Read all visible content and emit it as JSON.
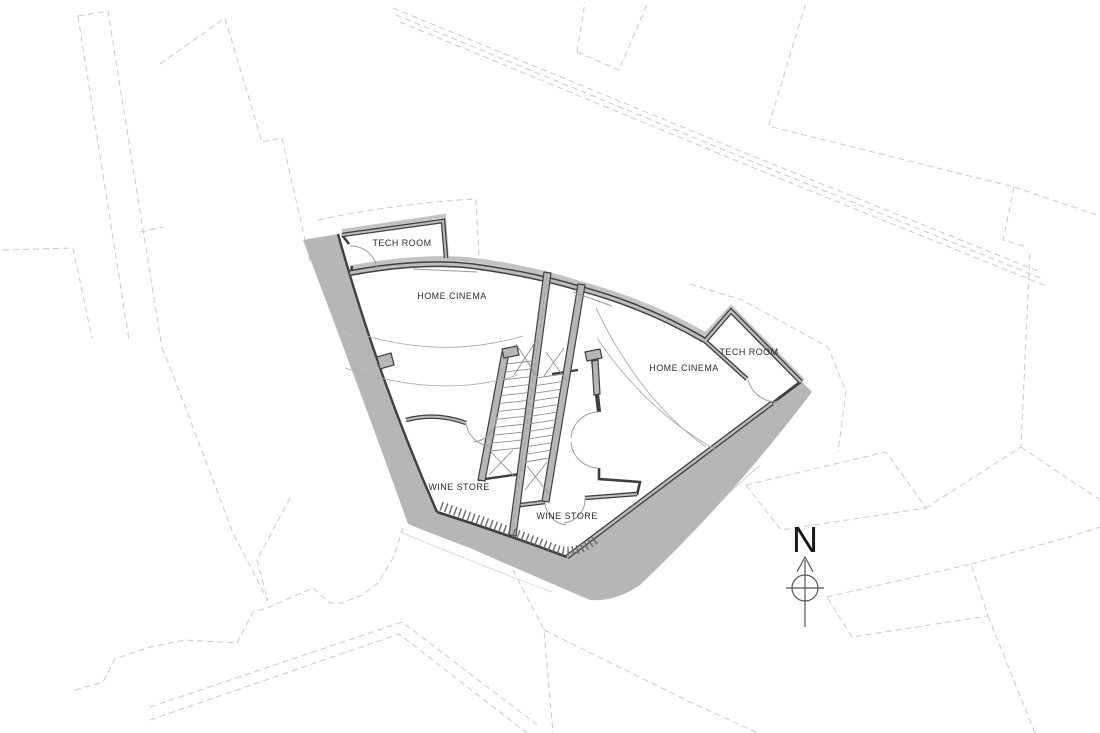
{
  "plan": {
    "units": [
      {
        "id": "left",
        "rooms": [
          {
            "label": "TECH ROOM"
          },
          {
            "label": "HOME CINEMA"
          },
          {
            "label": "WINE STORE"
          }
        ]
      },
      {
        "id": "right",
        "rooms": [
          {
            "label": "HOME CINEMA"
          },
          {
            "label": "TECH ROOM"
          },
          {
            "label": "WINE STORE"
          }
        ]
      }
    ],
    "north_marker": {
      "label": "N"
    },
    "colors": {
      "wall": "#3f3f3f",
      "band": "#b6b6b6",
      "wall_core": "#bcbcbc",
      "thin_line": "#9a9a9a",
      "dashed": "#c9c9c9",
      "text": "#2b2b2b",
      "north": "#1a1a1a"
    }
  }
}
